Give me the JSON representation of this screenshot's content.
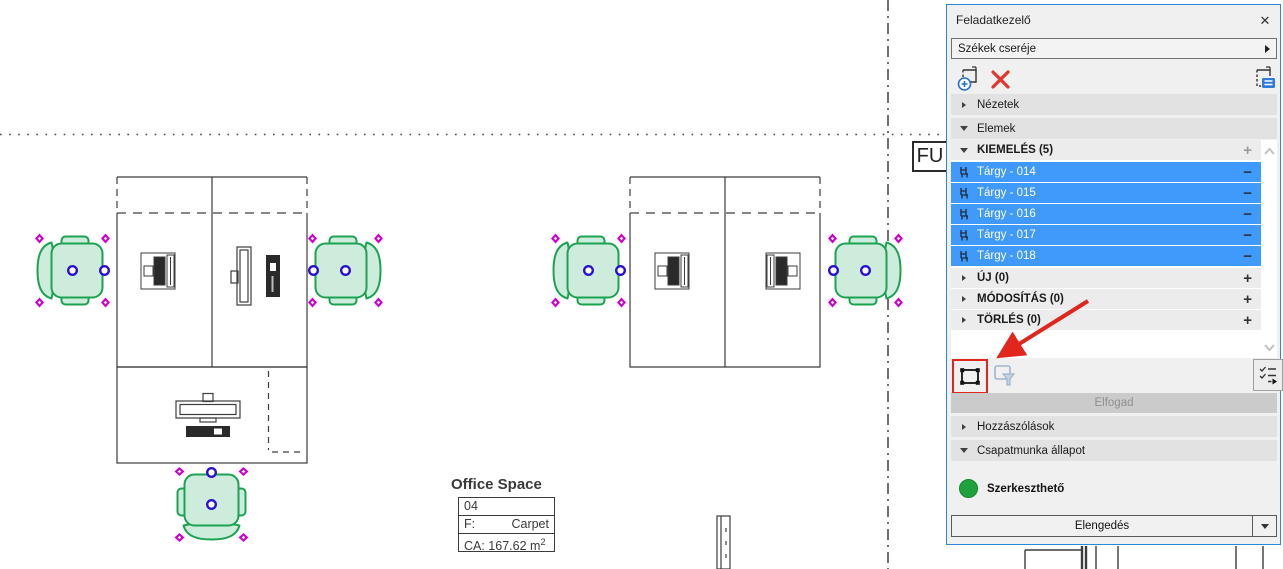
{
  "canvas": {
    "grid_bubble": {
      "label": "FU"
    },
    "room_stamp": {
      "title": "Office Space",
      "number": "04",
      "finish_key": "F:",
      "finish_value": "Carpet",
      "area_text": "CA: 167.62 m",
      "area_sup": "2"
    }
  },
  "panel": {
    "title": "Feladatkezelő",
    "close_glyph": "✕",
    "task_selector": {
      "value": "Székek cseréje"
    },
    "sections": {
      "nezetek": {
        "label": "Nézetek"
      },
      "elemek": {
        "label": "Elemek"
      },
      "kiemeles": {
        "label": "KIEMELÉS (5)",
        "add_glyph": "+",
        "items": [
          {
            "label": "Tárgy - 014",
            "remove_glyph": "−"
          },
          {
            "label": "Tárgy - 015",
            "remove_glyph": "−"
          },
          {
            "label": "Tárgy - 016",
            "remove_glyph": "−"
          },
          {
            "label": "Tárgy - 017",
            "remove_glyph": "−"
          },
          {
            "label": "Tárgy - 018",
            "remove_glyph": "−"
          }
        ]
      },
      "uj": {
        "label": "ÚJ (0)",
        "add_glyph": "+"
      },
      "modositas": {
        "label": "MÓDOSÍTÁS (0)",
        "add_glyph": "+"
      },
      "torles": {
        "label": "TÖRLÉS (0)",
        "add_glyph": "+"
      },
      "hozzaszolasok": {
        "label": "Hozzászólások"
      },
      "csapatmunka": {
        "label": "Csapatmunka állapot",
        "status_label": "Szerkeszthető"
      }
    },
    "buttons": {
      "accept": "Elfogad",
      "release": "Elengedés"
    }
  },
  "colors": {
    "selection_blue": "#3f9afc",
    "chair_outline_green": "#1ca352",
    "chair_fill_mint": "#cdecdc",
    "handle_magenta": "#cf00cf",
    "handle_blue": "#2a12cf",
    "annotation_red": "#e1261d",
    "status_green": "#1ea23c",
    "panel_border_blue": "#2e86d6"
  }
}
